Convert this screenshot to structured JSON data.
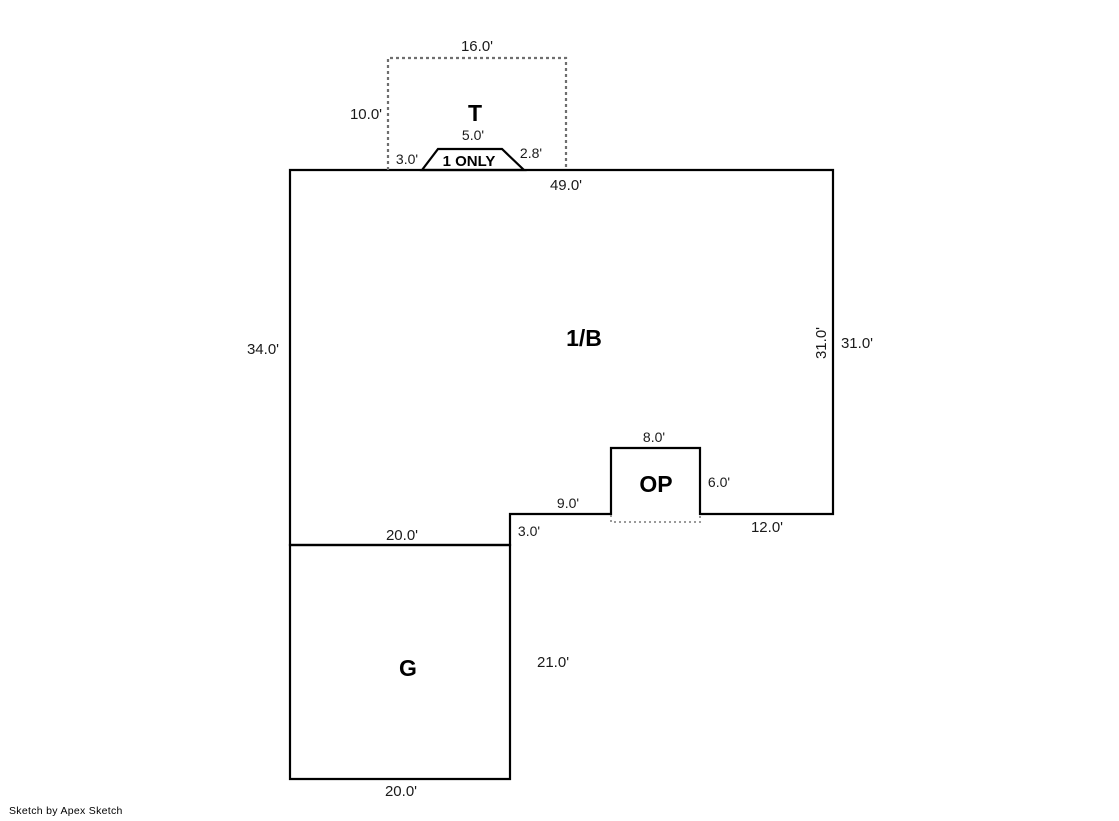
{
  "sketch": {
    "areas": {
      "attic": "T",
      "main": "1/B",
      "open_porch": "OP",
      "garage": "G"
    },
    "notes": {
      "stoop": "1 ONLY"
    },
    "dims": {
      "t_width": "16.0'",
      "t_height": "10.0'",
      "stoop_top": "5.0'",
      "stoop_left": "3.0'",
      "stoop_right": "2.8'",
      "main_top": "49.0'",
      "main_left": "34.0'",
      "main_right_inner": "31.0'",
      "main_right_outer": "31.0'",
      "op_width": "8.0'",
      "op_height": "6.0'",
      "bottom_left_segment": "9.0'",
      "bottom_step": "3.0'",
      "bottom_right_segment": "12.0'",
      "garage_top": "20.0'",
      "garage_right": "21.0'",
      "garage_bottom": "20.0'"
    },
    "colors": {
      "line": "#000000",
      "dashed_attachment": "#6e6e6e",
      "dotted_porch_edge": "#9a9a9a",
      "background": "#ffffff"
    }
  },
  "footer": {
    "credit": "Sketch by Apex Sketch"
  }
}
